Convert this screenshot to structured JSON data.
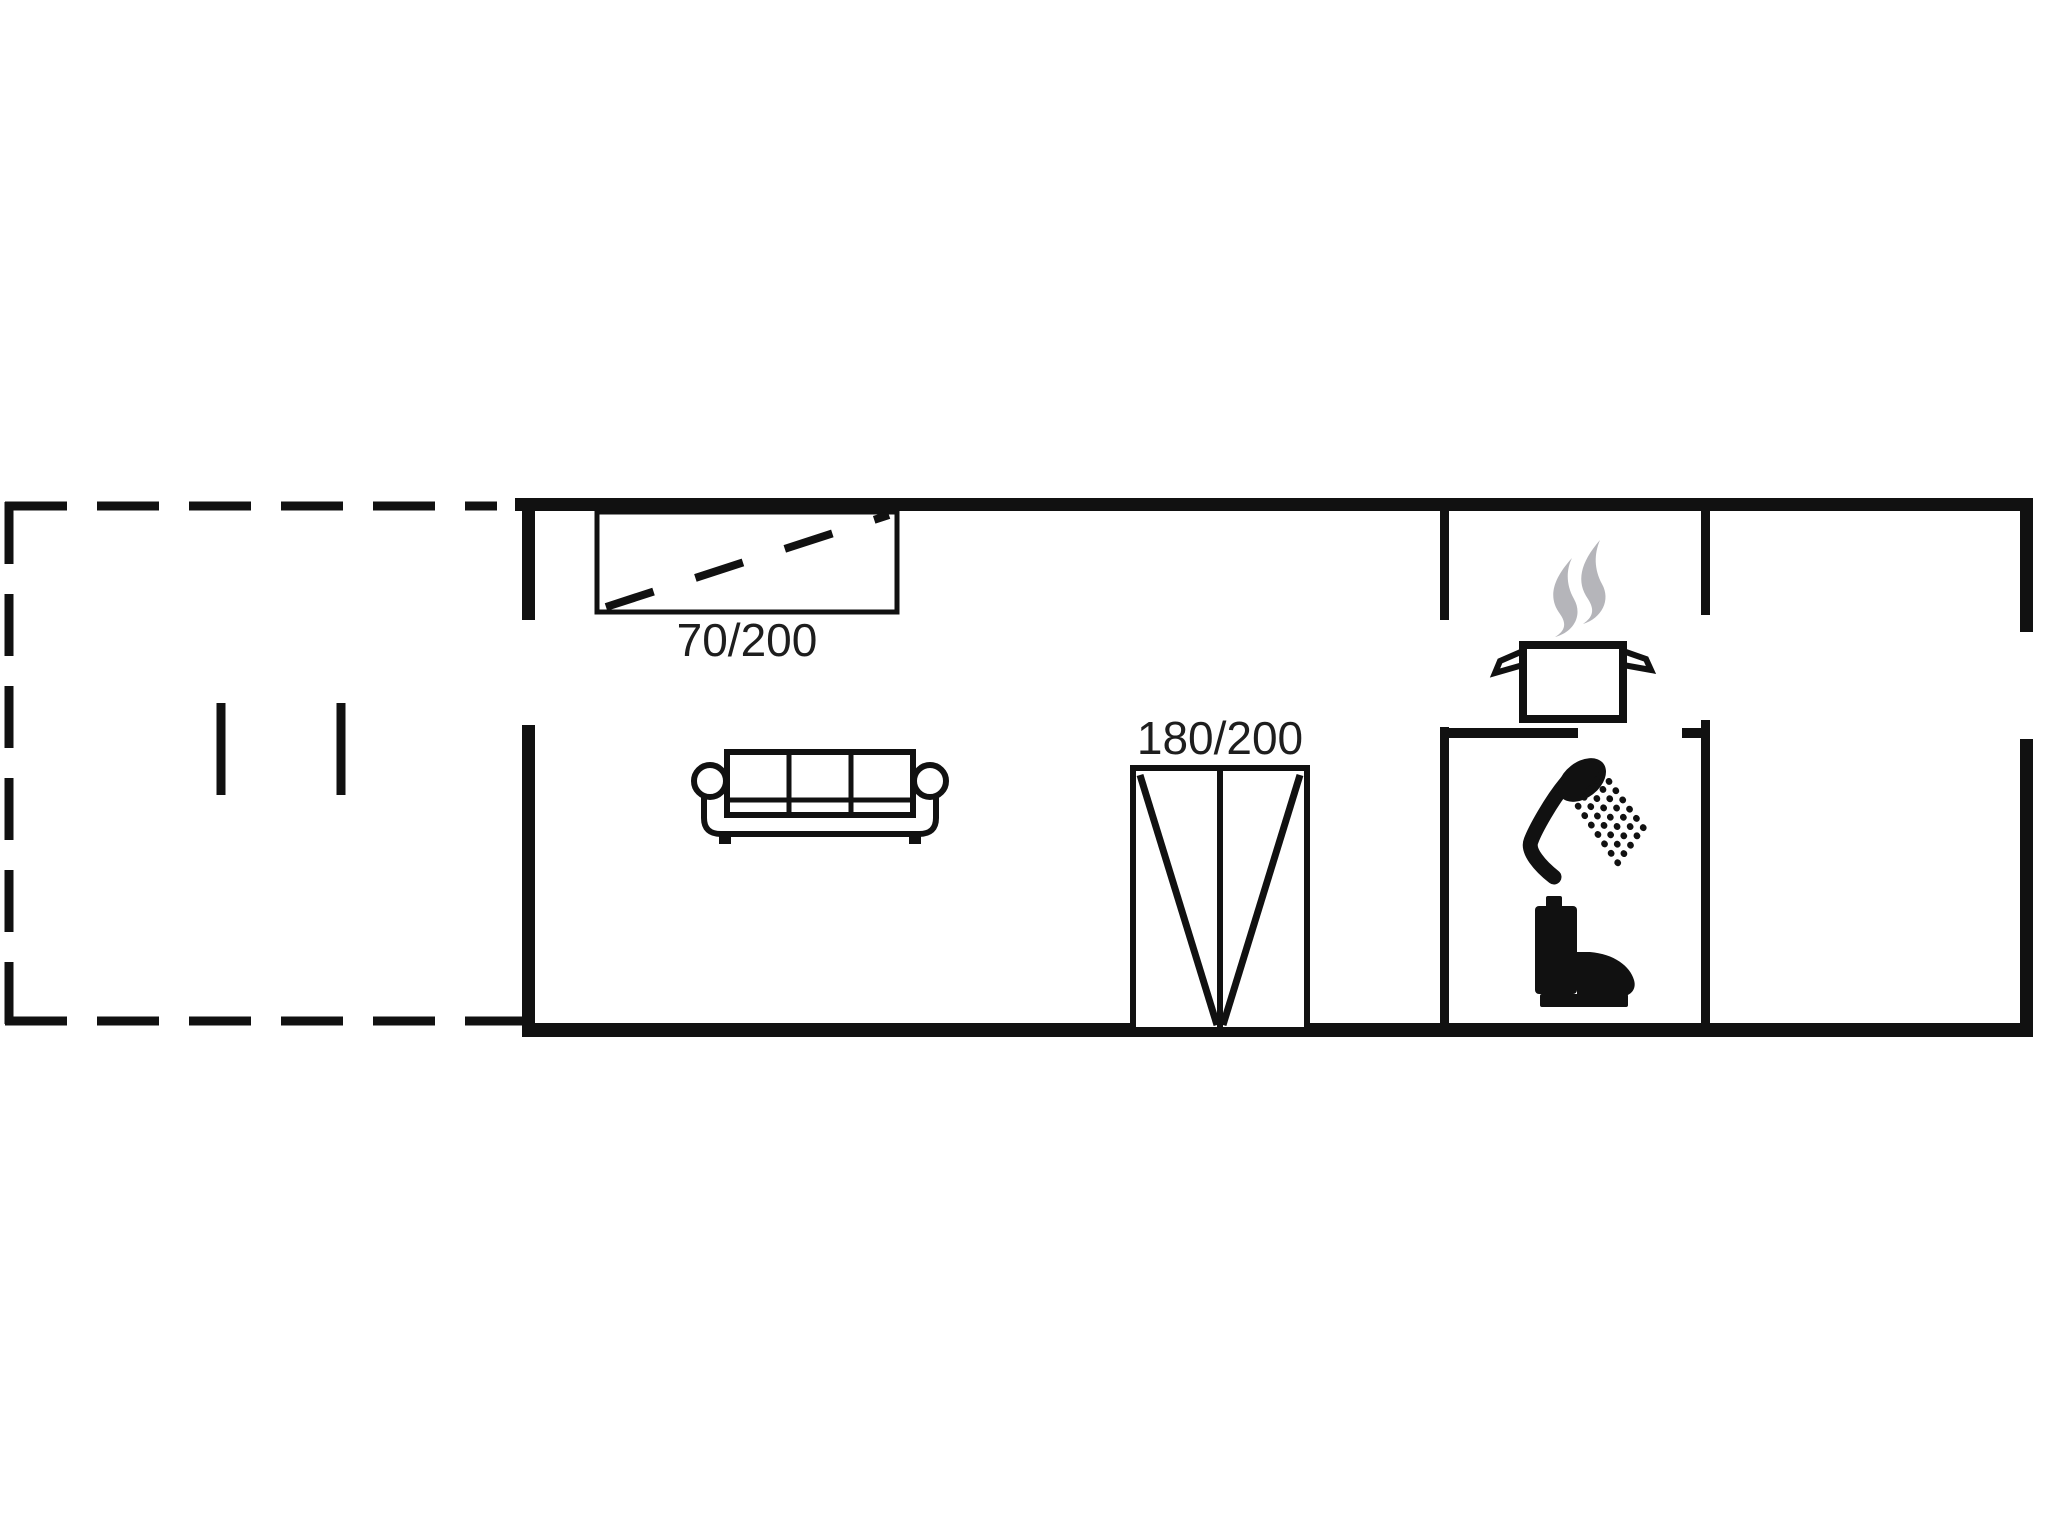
{
  "floorplan": {
    "labels": {
      "single_bed": "70/200",
      "double_bed": "180/200"
    },
    "icons": {
      "terrace_outline": "terrace-dashed-outline",
      "terrace_door_marks": "terrace-door-tick-marks",
      "single_bed": "single-bed-icon",
      "sofa": "sofa-icon",
      "double_bed": "double-bed-icon",
      "cooking_pot": "cooking-pot-icon",
      "steam": "steam-icon",
      "shower": "shower-head-icon",
      "toilet": "toilet-icon"
    },
    "colors": {
      "wall": "#111111",
      "furniture_stroke": "#111111",
      "steam": "#b5b5ba",
      "label_text": "#1e1e1e",
      "background": "#ffffff"
    }
  }
}
